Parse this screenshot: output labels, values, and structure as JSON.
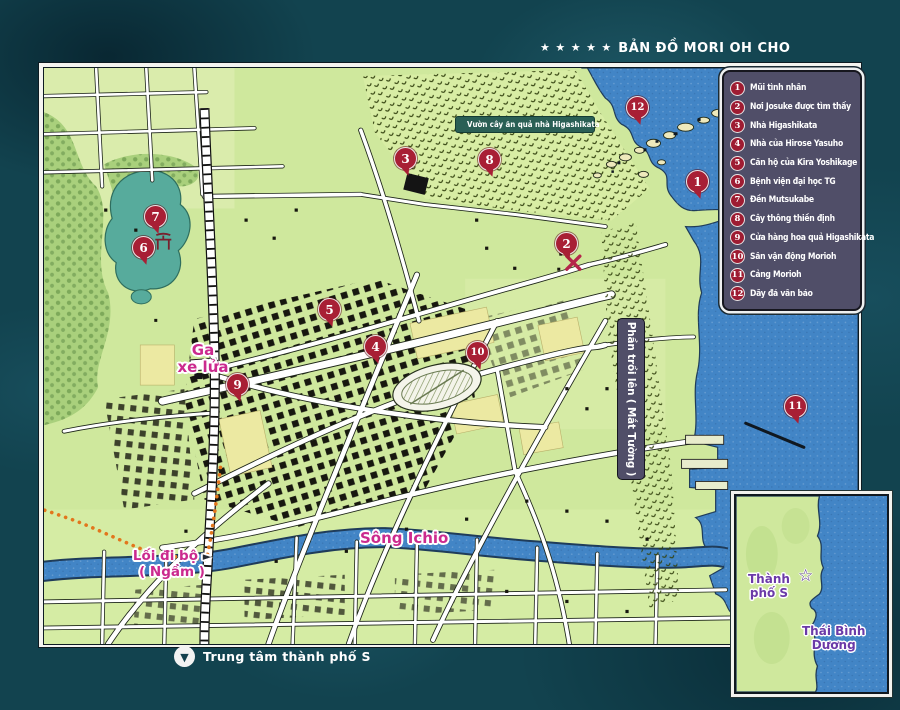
{
  "title": {
    "stars": "★ ★ ★ ★ ★",
    "text": "BẢN ĐỒ MORI OH CHO"
  },
  "legend": {
    "items": [
      {
        "num": "1",
        "label": "Mũi tình nhân"
      },
      {
        "num": "2",
        "label": "Nơi Josuke được tìm thấy"
      },
      {
        "num": "3",
        "label": "Nhà Higashikata"
      },
      {
        "num": "4",
        "label": "Nhà của Hirose Yasuho"
      },
      {
        "num": "5",
        "label": "Căn hộ của Kira Yoshikage"
      },
      {
        "num": "6",
        "label": "Bệnh viện đại học TG"
      },
      {
        "num": "7",
        "label": "Đền Mutsukabe"
      },
      {
        "num": "8",
        "label": "Cây thông thiền định"
      },
      {
        "num": "9",
        "label": "Cửa hàng hoa quả Higashikata"
      },
      {
        "num": "10",
        "label": "Sân vận động Morioh"
      },
      {
        "num": "11",
        "label": "Cảng Morioh"
      },
      {
        "num": "12",
        "label": "Dãy đá vân báo"
      }
    ]
  },
  "labels": {
    "orchard": "Vườn cây ăn quả nhà Higashikata",
    "station": [
      "Ga",
      "xe lửa"
    ],
    "river": "Sông Ichio",
    "walkway": [
      "Lối đi bộ",
      "( Ngầm )"
    ],
    "wall_eyes": "Phần trồi lên ( Mắt Tường )"
  },
  "footer": {
    "caption": "Trung tâm thành phố S"
  },
  "inset": {
    "city": [
      "Thành",
      "phố S"
    ],
    "ocean": [
      "Thái Bình",
      "Dương"
    ]
  },
  "icons": {
    "star_solid": "★",
    "star_outline": "☆",
    "walkway_arrow": "►",
    "down_circle": "▼",
    "torii": "torii-gate",
    "x_mark": "x-cross",
    "pin": "numbered-pin"
  },
  "colors": {
    "ocean_bg": "#12434f",
    "sea": "#4285c6",
    "land": "#cfe89d",
    "forest": "#a9d07c",
    "lake": "#57ab9c",
    "marker_red": "#a81f35",
    "legend_bg": "#504e68",
    "label_magenta": "#cb2a8e",
    "label_purple": "#6b3aa8",
    "badge_teal": "#2a5f55",
    "road_white": "#ffffff",
    "building_black": "#17170f",
    "path_orange": "#e2761c"
  }
}
